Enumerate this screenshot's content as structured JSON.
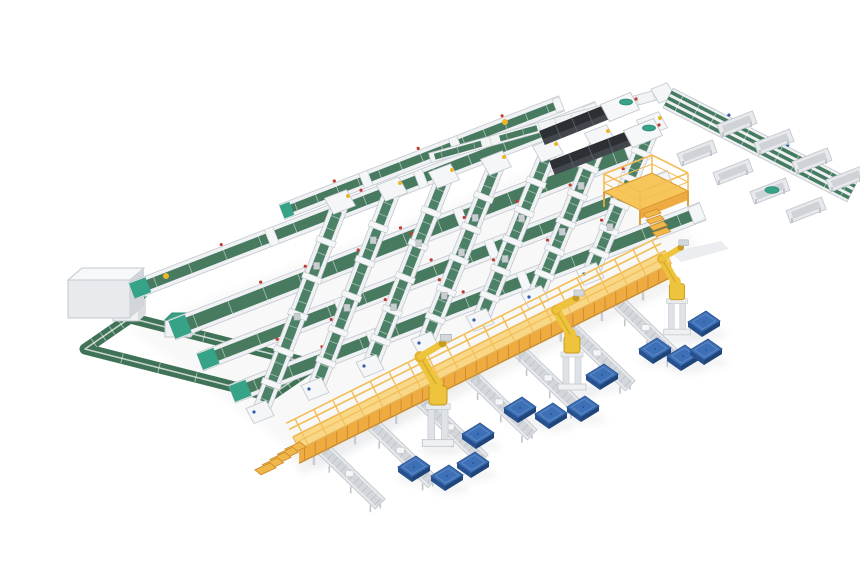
{
  "meta": {
    "label": "isometric 3d render of automated parcel sorting warehouse system",
    "canvas": {
      "w": 860,
      "h": 580
    },
    "background": "#ffffff"
  },
  "palette": {
    "row_green": "#487a60",
    "lane_green": "#4d8167",
    "loop_green": "#3f7256",
    "outbound_green": "#457b61",
    "belt_dark": "#2f5d49",
    "frame_light": "#eff1f4",
    "frame_mid": "#d9dce0",
    "frame_stroke": "#c3c8cd",
    "tray_fill": "#e7e9ec",
    "tray_inner": "#cfd3d8",
    "walk_deck": "#f8d887",
    "walk_deck_edge": "#e8b34f",
    "walk_face": "#eeab42",
    "walk_strut": "#cf8c2d",
    "walk_rail": "#f3bd54",
    "robot_yellow": "#eec43d",
    "robot_shade": "#c79d24",
    "pallet_top": "#3d70b6",
    "pallet_side": "#27508e",
    "pallet_side2": "#1f4478",
    "pallet_line": "#6d92c8",
    "dark_top": "#2c2f34",
    "dark_side": "#43474d",
    "teal": "#36a287",
    "red_dot": "#c43b2e",
    "blue_dot": "#2f5fa8",
    "yellow_item": "#e9b62a",
    "shadow": "#8a909a"
  },
  "scene": {
    "east": [
      0.932,
      -0.362
    ],
    "rows": [
      {
        "x": 282,
        "y": 212,
        "len": 300,
        "w": 11
      },
      {
        "x": 132,
        "y": 291,
        "len": 500,
        "w": 13
      },
      {
        "x": 172,
        "y": 330,
        "len": 500,
        "w": 16
      },
      {
        "x": 200,
        "y": 362,
        "len": 505,
        "w": 14
      },
      {
        "x": 232,
        "y": 394,
        "len": 505,
        "w": 14
      }
    ],
    "spine_item": [
      166,
      276
    ],
    "lanes": [
      {
        "tx": 340,
        "ty": 205,
        "bx": 262,
        "by": 408,
        "parcels": [
          0.3,
          0.55
        ]
      },
      {
        "tx": 392,
        "ty": 192,
        "bx": 317,
        "by": 385,
        "parcels": [
          0.25,
          0.6
        ]
      },
      {
        "tx": 444,
        "ty": 179,
        "bx": 372,
        "by": 362,
        "parcels": [
          0.35,
          0.7
        ]
      },
      {
        "tx": 496,
        "ty": 166,
        "bx": 427,
        "by": 339,
        "parcels": [
          0.3,
          0.5,
          0.75
        ]
      },
      {
        "tx": 548,
        "ty": 153,
        "bx": 482,
        "by": 316,
        "parcels": [
          0.4,
          0.65
        ]
      },
      {
        "tx": 600,
        "ty": 140,
        "bx": 537,
        "by": 293,
        "parcels": [
          0.3,
          0.6
        ]
      },
      {
        "tx": 652,
        "ty": 127,
        "bx": 592,
        "by": 270,
        "parcels": [
          0.45,
          0.7
        ]
      }
    ],
    "loop": {
      "path": [
        [
          130,
          318
        ],
        [
          315,
          365
        ],
        [
          270,
          396
        ],
        [
          85,
          349
        ]
      ],
      "machines": [
        [
          126,
          312
        ],
        [
          178,
          328
        ]
      ]
    },
    "box_machine": {
      "x": 68,
      "y": 280,
      "w": 62,
      "h": 38,
      "d": 14
    },
    "top_row": {
      "x1": 430,
      "y1": 158,
      "x2": 663,
      "y2": 93,
      "item": [
        505,
        122
      ]
    },
    "corner_box": [
      663,
      93
    ],
    "outbound": {
      "x1": 668,
      "y1": 98,
      "x2": 852,
      "y2": 192
    },
    "trays": [
      {
        "x": 737,
        "y": 124,
        "teal": false
      },
      {
        "x": 774,
        "y": 142,
        "teal": false
      },
      {
        "x": 812,
        "y": 161,
        "teal": false
      },
      {
        "x": 846,
        "y": 179,
        "teal": false
      },
      {
        "x": 697,
        "y": 153,
        "teal": false
      },
      {
        "x": 733,
        "y": 172,
        "teal": false
      },
      {
        "x": 770,
        "y": 191,
        "teal": true
      },
      {
        "x": 806,
        "y": 210,
        "teal": false
      }
    ],
    "unloaders": [
      {
        "x1": 542,
        "y1": 138,
        "x2": 607,
        "y2": 112,
        "head": [
          620,
          107
        ]
      },
      {
        "x1": 552,
        "y1": 168,
        "x2": 630,
        "y2": 138,
        "head": [
          643,
          133
        ]
      }
    ],
    "platform": {
      "floor": [
        [
          604,
          192
        ],
        [
          652,
          173
        ],
        [
          688,
          191
        ],
        [
          640,
          210
        ]
      ],
      "stairs": [
        650,
        214
      ]
    },
    "walkway": {
      "x1": 296,
      "y1": 443,
      "x2": 668,
      "y2": 257,
      "deck_w": 14,
      "face_d": 14,
      "rail_h": 15,
      "stairs": [
        294,
        446
      ],
      "ramp": [
        671,
        252
      ]
    },
    "spurs": [
      {
        "x": 319,
        "y": 445,
        "len": 85
      },
      {
        "x": 368,
        "y": 420,
        "len": 90
      },
      {
        "x": 417,
        "y": 396,
        "len": 92
      },
      {
        "x": 466,
        "y": 371,
        "len": 92
      },
      {
        "x": 515,
        "y": 347,
        "len": 92
      },
      {
        "x": 564,
        "y": 322,
        "len": 92
      },
      {
        "x": 614,
        "y": 298,
        "len": 88
      }
    ],
    "spur_dir": [
      0.72,
      0.694
    ],
    "robots": [
      {
        "x": 438,
        "y": 443,
        "s": 1.12
      },
      {
        "x": 572,
        "y": 387,
        "s": 1.0
      },
      {
        "x": 677,
        "y": 332,
        "s": 0.95
      }
    ],
    "pallets": [
      [
        414,
        467
      ],
      [
        447,
        476
      ],
      [
        473,
        463
      ],
      [
        478,
        434
      ],
      [
        520,
        408
      ],
      [
        551,
        414
      ],
      [
        583,
        407
      ],
      [
        602,
        375
      ],
      [
        655,
        349
      ],
      [
        683,
        356
      ],
      [
        706,
        350
      ],
      [
        704,
        322
      ]
    ]
  }
}
